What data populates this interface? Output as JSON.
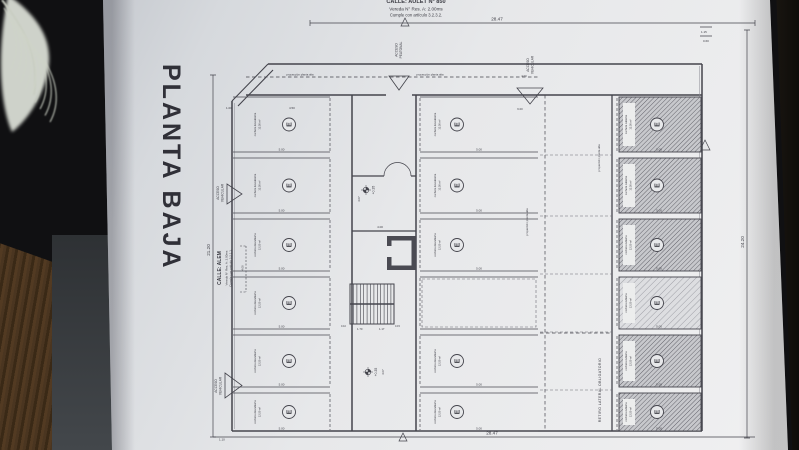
{
  "title": "PLANTA BAJA",
  "streets": {
    "top": {
      "name": "CALLE: AULET N° 850",
      "line2": "Vereda N° Res. A: 2.00ms",
      "line3": "Cumple con artículo 3.2.3.2."
    },
    "left": {
      "name": "CALLE: ALEM",
      "line2": "Vereda N° Res. A: 2.00ms",
      "line3": "Cumple con artículo 3.2.1.1."
    }
  },
  "accesses": {
    "acceso": "ACCESO",
    "vehicular": "VEHICULAR",
    "peatonal": "PEATONAL"
  },
  "labels": {
    "retiro": "RETIRO LATERAL OBLIGATORIO",
    "proyeccion": "proyección planta alta",
    "level": "+0.35"
  },
  "units": {
    "symbol": "E",
    "open_label": "cochera descubierta",
    "covered_label": "cochera cubierta",
    "area": "12.50 m²",
    "depth_dim": "5.00"
  },
  "dims": {
    "top_total": "28.47",
    "bottom_total": "28.47",
    "left_total": "21.20",
    "right_total": "24.20",
    "d100": "1.00",
    "d450": "4.50",
    "d400": "4.00",
    "d600": "6.00",
    "d115": "1.15",
    "d060": "0.60",
    "d407": "4.07",
    "d110": "1.10",
    "d170": "1.70",
    "d117": "1.17",
    "d015": "0.15",
    "d010": "0.10"
  },
  "colors": {
    "paper": "#e7e8ea",
    "ink": "#44444c",
    "hatch": "#5a5a62",
    "wood": "#46311d",
    "table_dark": "#0d0d0f",
    "slab": "#3f4347"
  }
}
